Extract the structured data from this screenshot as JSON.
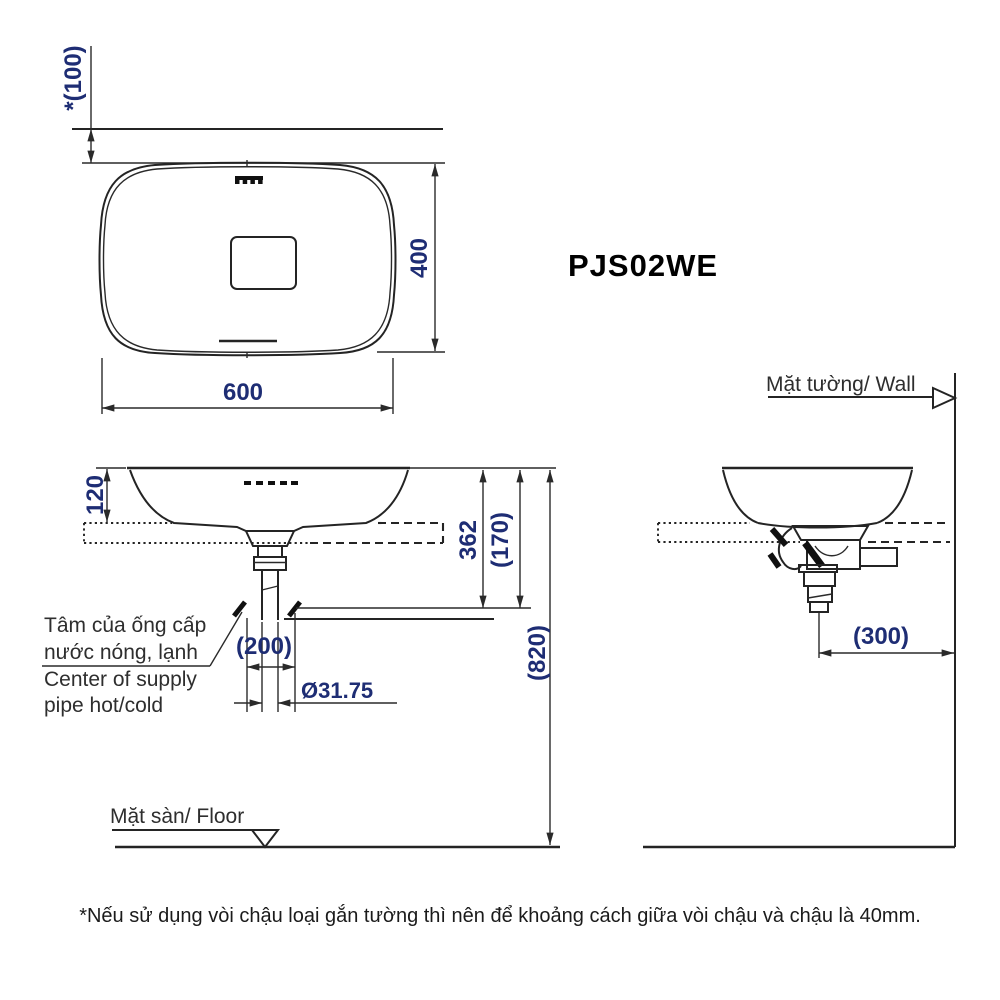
{
  "drawing": {
    "model": "PJS02WE",
    "top_view": {
      "wall_offset": "*(100)",
      "width": "600",
      "depth": "400"
    },
    "front_view": {
      "rim_to_counter": "120",
      "rim_to_drain_end": "362",
      "rim_to_supply": "(170)",
      "rim_to_floor": "(820)",
      "supply_spacing": "(200)",
      "drain_diameter": "Ø31.75",
      "supply_note_line1": "Tâm của ống cấp",
      "supply_note_line2": "nước nóng, lạnh",
      "supply_note_line3": "Center of supply",
      "supply_note_line4": "pipe hot/cold",
      "floor_label": "Mặt sàn/ Floor"
    },
    "side_view": {
      "wall_label": "Mặt tường/ Wall",
      "drain_to_wall": "(300)"
    },
    "footnote": "*Nếu sử dụng vòi chậu loại gắn tường thì nên để khoảng cách giữa vòi chậu và chậu là 40mm.",
    "colors": {
      "dimension_text": "#1e2d74",
      "line": "#2a2a2a",
      "label_text": "#2e2e2e"
    }
  }
}
